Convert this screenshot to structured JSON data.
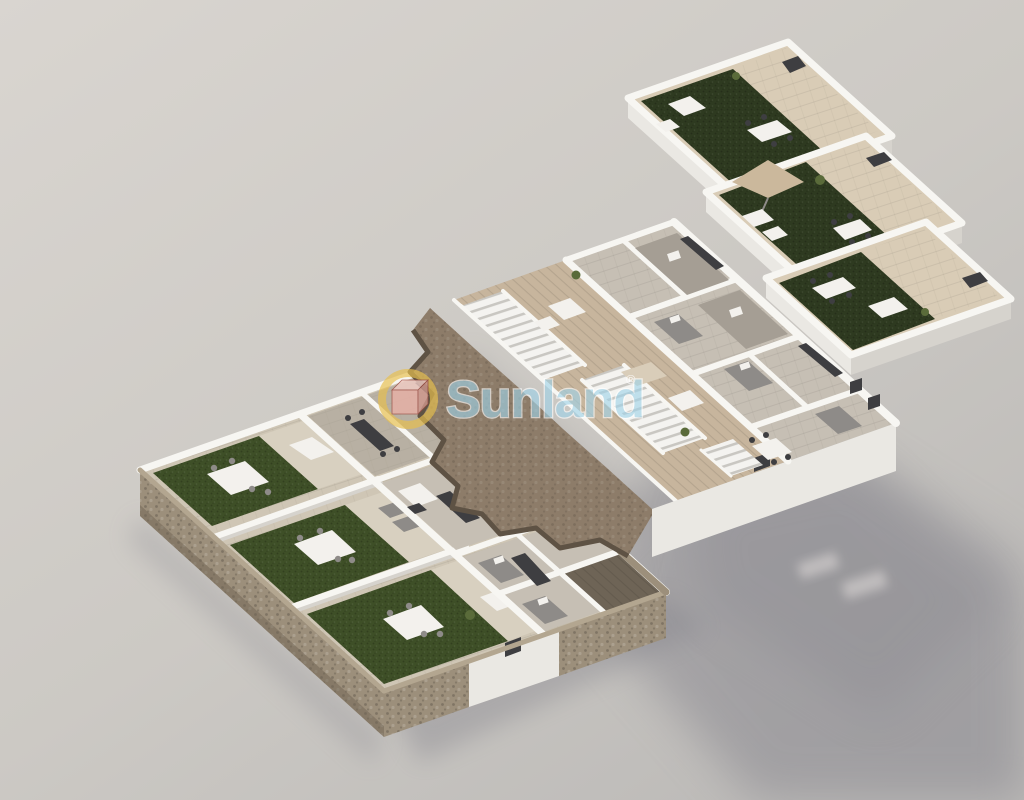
{
  "watermark": {
    "text": "Sunland",
    "registered_mark": "®"
  },
  "palette": {
    "bg_top": "#d9d5d0",
    "bg_mid": "#ccc9c4",
    "bg_bottom": "#bbb9b7",
    "shadow": "#85848c",
    "shadow_light_spot": "#c2bfc0",
    "wall_top": "#f7f6f2",
    "wall_front": "#eae8e3",
    "wall_shade": "#d6d3cd",
    "tile_patio": "#cfc6b5",
    "tile_light": "#d8d0c0",
    "tile_roof": "#d9ccb6",
    "floor_room": "#c6bfb4",
    "floor_dark": "#a59e94",
    "wood_terrace": "#c7b59d",
    "wood_courtyard": "#6e6456",
    "turf_garden": "#3e4f27",
    "turf_roof": "#2e3a20",
    "stone": "#9c8f7b",
    "stone_dark": "#6f6353",
    "stone_light": "#b3a690",
    "terrain": "#8d7c69",
    "terrain_dark": "#5e5244",
    "stair_tread": "#c9c7c2",
    "furn_dark": "#3e3e41",
    "furn_gray": "#8e8b88",
    "furn_white": "#f3f1ed",
    "furn_beige": "#d9cdb9",
    "plant": "#5a6b3a",
    "parasol": "#cbb89c",
    "wm_text": "#9fd2e8",
    "wm_outline": "#ffffff",
    "wm_ring": "#e7c04f",
    "wm_cube_top": "#f2cdc5",
    "wm_cube_front": "#e8b0a6",
    "wm_cube_side": "#cf978c",
    "wm_cube_edge": "#9c4a40"
  }
}
